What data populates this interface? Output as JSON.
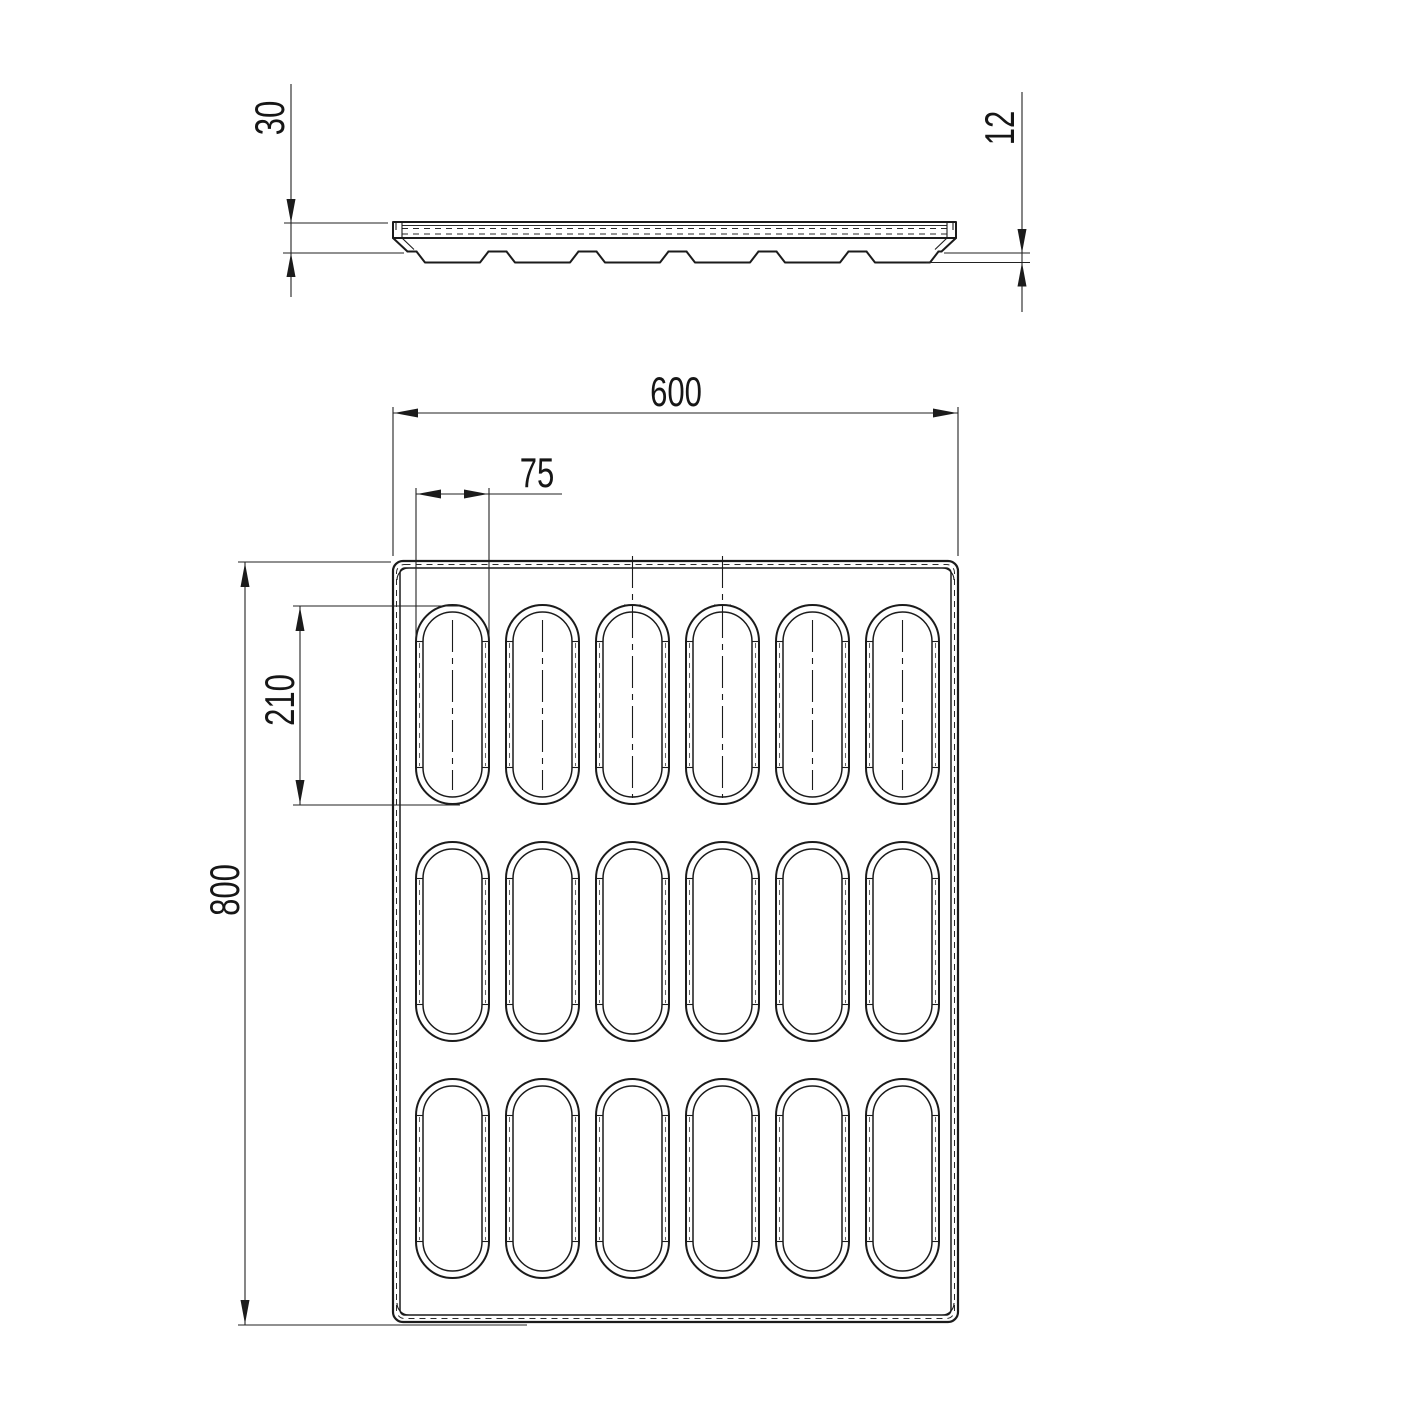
{
  "drawing": {
    "type": "technical-drawing",
    "subject": "baking tray with oval cavities",
    "background": "#ffffff",
    "line_color": "#1b1b1b",
    "views": {
      "side_profile": {
        "label": "side profile view",
        "feet_count": 6,
        "dimensions": {
          "rim_height": "30",
          "cavity_depth": "12"
        }
      },
      "plan": {
        "label": "top plan view",
        "rows": 3,
        "columns": 6,
        "cavity_count": 18,
        "dimensions": {
          "overall_width": "600",
          "overall_length": "800",
          "cavity_width": "75",
          "cavity_length": "210"
        }
      }
    },
    "dimensions": {
      "overall_width": "600",
      "overall_length": "800",
      "cavity_width": "75",
      "cavity_length": "210",
      "rim_height": "30",
      "cavity_depth": "12"
    }
  }
}
